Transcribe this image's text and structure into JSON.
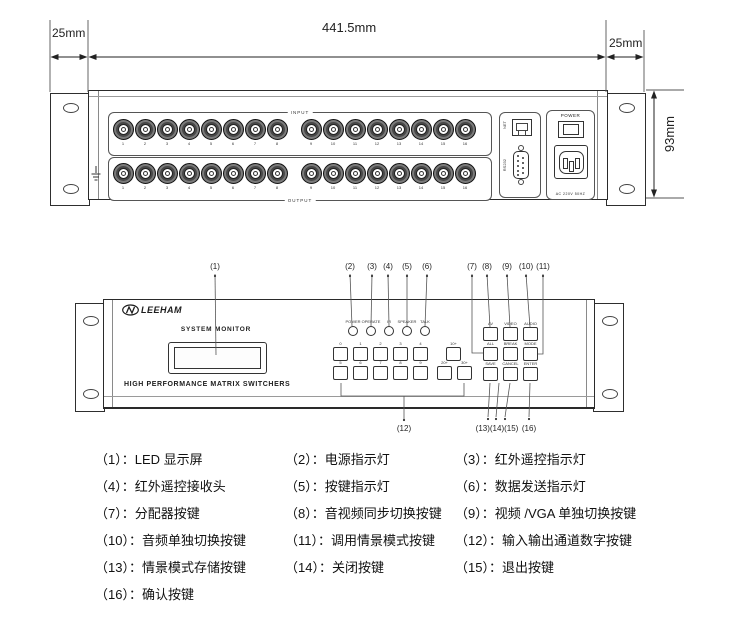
{
  "dimensions": {
    "left_margin": "25mm",
    "total_width": "441.5mm",
    "right_margin": "25mm",
    "height": "93mm"
  },
  "rear_panel": {
    "input_label": "INPUT",
    "output_label": "OUTPUT",
    "input_numbers": [
      "1",
      "2",
      "3",
      "4",
      "5",
      "6",
      "7",
      "8",
      "9",
      "10",
      "11",
      "12",
      "13",
      "14",
      "15",
      "16"
    ],
    "output_numbers": [
      "1",
      "2",
      "3",
      "4",
      "5",
      "6",
      "7",
      "8",
      "9",
      "10",
      "11",
      "12",
      "13",
      "14",
      "15",
      "16"
    ],
    "net_label": "NET",
    "rs232_label": "RS232",
    "power_label": "POWER",
    "ac_label": "AC 220V 50HZ"
  },
  "front_panel": {
    "brand": "LEEHAM",
    "brand_mark": "N",
    "display_title": "SYSTEM MONITOR",
    "panel_title": "HIGH PERFORMANCE MATRIX SWITCHERS",
    "leds": [
      "POWER",
      "OPERATE",
      "IR",
      "SPEAKER",
      "TALK"
    ],
    "digit_row1": [
      "0",
      "1",
      "2",
      "3",
      "4"
    ],
    "digit_row2": [
      "5",
      "6",
      "7",
      "8",
      "9"
    ],
    "plus10": "10+",
    "plus20": "20+",
    "plus30": "30+",
    "fn_row1": [
      "AV",
      "VIDEO",
      "AUDIO"
    ],
    "fn_row2": [
      "ALL",
      "BREAK",
      "MODE"
    ],
    "fn_row3": [
      "SAVE",
      "CANCEL",
      "ENTER"
    ]
  },
  "callouts": {
    "top": [
      "(1)",
      "(2)",
      "(3)",
      "(4)",
      "(5)",
      "(6)",
      "(7)",
      "(8)",
      "(9)",
      "(10)",
      "(11)"
    ],
    "bottom": [
      "(12)",
      "(13)(14)(15)",
      "(16)"
    ]
  },
  "legend": {
    "items": [
      "（1）：LED 显示屏",
      "（2）：电源指示灯",
      "（3）：红外遥控指示灯",
      "（4）：红外遥控接收头",
      "（5）：按键指示灯",
      "（6）：数据发送指示灯",
      "（7）：分配器按键",
      "（8）：音视频同步切换按键",
      "（9）：视频 /VGA 单独切换按键",
      "（10）：音频单独切换按键",
      "（11）：调用情景模式按键",
      "（12）：输入输出通道数字按键",
      "（13）：情景模式存储按键",
      "（14）：关闭按键",
      "（15）：退出按键",
      "（16）：确认按键"
    ]
  }
}
